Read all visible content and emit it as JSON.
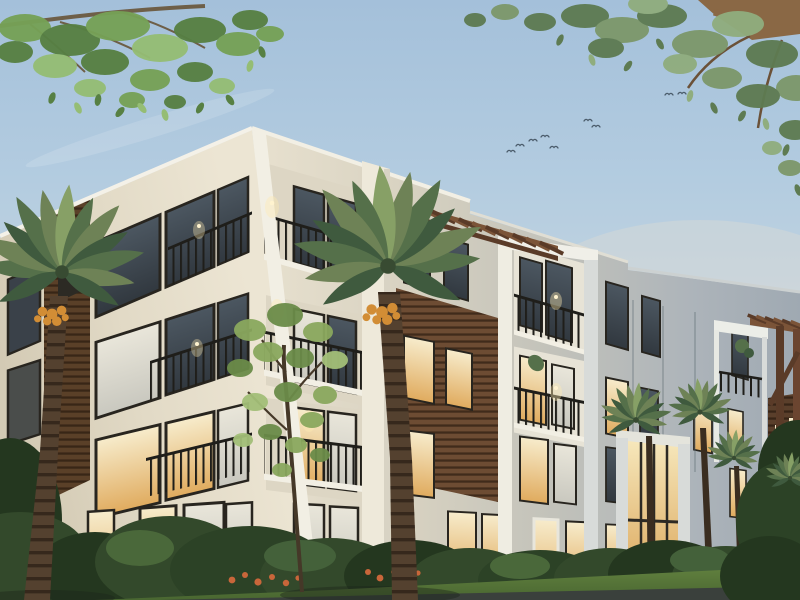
{
  "scene": {
    "description": "Dusk architectural rendering of a modern four-story apartment building with white balcony frames, dark wood accent panels, black metal railings and warmly lit windows; palm trees and hedges in the foreground, overhanging leafy branches framing the top corners, and a small flock of birds in a pale blue evening sky",
    "time_of_day": "dusk",
    "building": {
      "stories": 4,
      "style": "modern-contemporary",
      "features": [
        "white frame balconies",
        "black metal railings",
        "wood slat accent panels",
        "rooftop pergola",
        "corner pergola trellis",
        "tall glazed entry",
        "wall sconces lit"
      ]
    },
    "objects": [
      {
        "name": "sky",
        "description": "pale blue dusk sky fading to warm haze at the horizon"
      },
      {
        "name": "birds",
        "description": "small flock flying in loose formation",
        "count": 9
      },
      {
        "name": "overhanging-branch-left",
        "description": "green leafy branch entering from top-left corner"
      },
      {
        "name": "overhanging-branch-right",
        "description": "thick brown branch with sage-green leaves entering from top-right corner"
      },
      {
        "name": "apartment-building",
        "description": "four-story corner view, lit cream left facade, shaded blue-gray right facade"
      },
      {
        "name": "rooftop-pergola",
        "description": "brown wood rafters on the roof above the wood-panel bay"
      },
      {
        "name": "corner-pergola",
        "description": "tall brown trellis frame at far right of building"
      },
      {
        "name": "palm-trees",
        "description": "two large date palms with orange fruit plus three small palms near the entry",
        "count": 5
      },
      {
        "name": "small-tree",
        "description": "young deciduous tree in front of the left facade"
      },
      {
        "name": "hedges",
        "description": "dense green shrubs with orange flower patches along the building base"
      },
      {
        "name": "lawn-and-street",
        "description": "green lawn strip and dark pavement at the bottom edge"
      }
    ],
    "counts": {
      "birds": 9,
      "palm_trees": 5,
      "pergolas": 2,
      "railed_balconies": 10,
      "lit_windows_approx": 26
    }
  },
  "colors": {
    "sky_top": "#a4c0da",
    "sky_mid": "#bcd0e0",
    "sky_low": "#cfd9de",
    "sky_horizon": "#ded9cd",
    "warm_glow": "#eadbc6",
    "wall_lit": "#eae3d1",
    "wall_lit_shade": "#ddd6c4",
    "wall_far": "#a8b1b8",
    "trim_white": "#f2efe4",
    "trim_shade": "#d8dbd9",
    "frame_dark": "#28251f",
    "railing": "#1f1e1a",
    "glass_warm": "#f2dfa8",
    "glass_warm_deep": "#dfae62",
    "glass_pale": "#e7e3d6",
    "glass_dark": "#414b55",
    "wood": "#6d4c33",
    "wood_dark": "#4f3724",
    "pergola": "#7b5438",
    "pergola_dark": "#5a3b28",
    "palm_green_1": "#6e8256",
    "palm_green_2": "#55704a",
    "palm_green_3": "#3f5a3e",
    "palm_green_4": "#87a066",
    "trunk": "#54412f",
    "trunk_dark": "#3a2d20",
    "dates": "#d28d35",
    "leaf_tl_1": "#76a156",
    "leaf_tl_2": "#578043",
    "leaf_tl_3": "#95bd74",
    "leaf_tr_1": "#7d986b",
    "leaf_tr_2": "#5e7b52",
    "leaf_tr_3": "#90ad7e",
    "branch": "#6e5f48",
    "branch_tr": "#8a6845",
    "bush": "#33492b",
    "bush_dark": "#24371f",
    "bush_light": "#4a683a",
    "flower": "#c9663a",
    "lawn": "#5a7a3c",
    "lawn_dark": "#44622e",
    "road": "#3a403c",
    "bird": "#4b5c6b",
    "sconce": "#ffeab2"
  }
}
